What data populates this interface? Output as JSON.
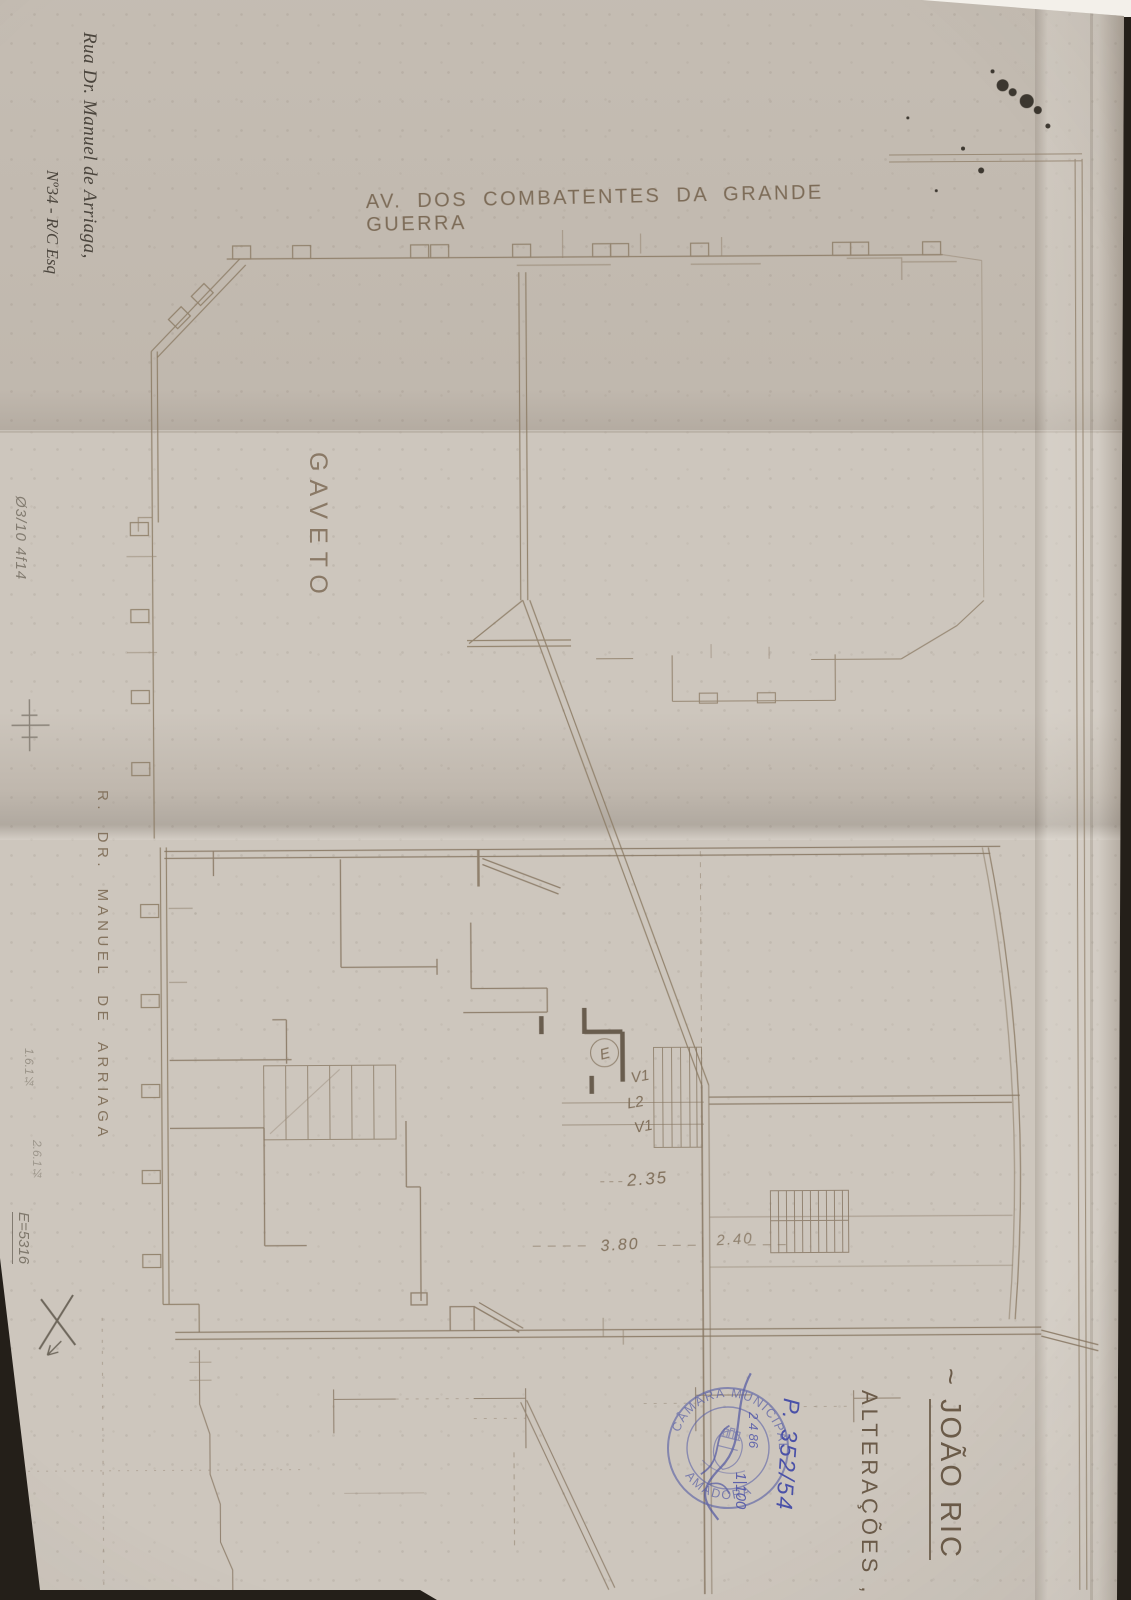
{
  "plan": {
    "street_top": "AV. DOS COMBATENTES DA GRANDE GUERRA",
    "corner_label": "GAVETO",
    "street_left": "R. DR. MANUEL DE ARRIAGA",
    "labels": {
      "elevator": "E",
      "v1a": "V1",
      "l2": "L2",
      "v1b": "V1"
    },
    "dimensions": {
      "hall": "2.35",
      "room_a": "3.80",
      "room_b": "2.40"
    }
  },
  "annotations": {
    "address_line1": "Rua Dr. Manuel de Arriaga,",
    "address_line2": "Nº34 - R/C Esq",
    "pencil_note_top": "Ø3/10 4f14",
    "pencil_note_1": "1.6.1¼",
    "pencil_note_2": "2.6.1¼",
    "pencil_note_3": "E=5316",
    "title_prefix": "~ ",
    "title": "JOÃO RIC",
    "subtitle": "ALTERAÇÕES ,"
  },
  "stamp": {
    "arc_top": "CÂMARA MUNICIPAL DA",
    "arc_bottom": "AMADORA"
  },
  "ink_notes": {
    "process": "P. 352/54",
    "date": "2 4 86",
    "scale": "1|100"
  },
  "colors": {
    "paper": "#cdc6bd",
    "drawing_line": "#8a7962",
    "stamp_blue": "#565da6",
    "pen_blue": "#4a51a8",
    "pencil_gray": "#6e675c"
  }
}
